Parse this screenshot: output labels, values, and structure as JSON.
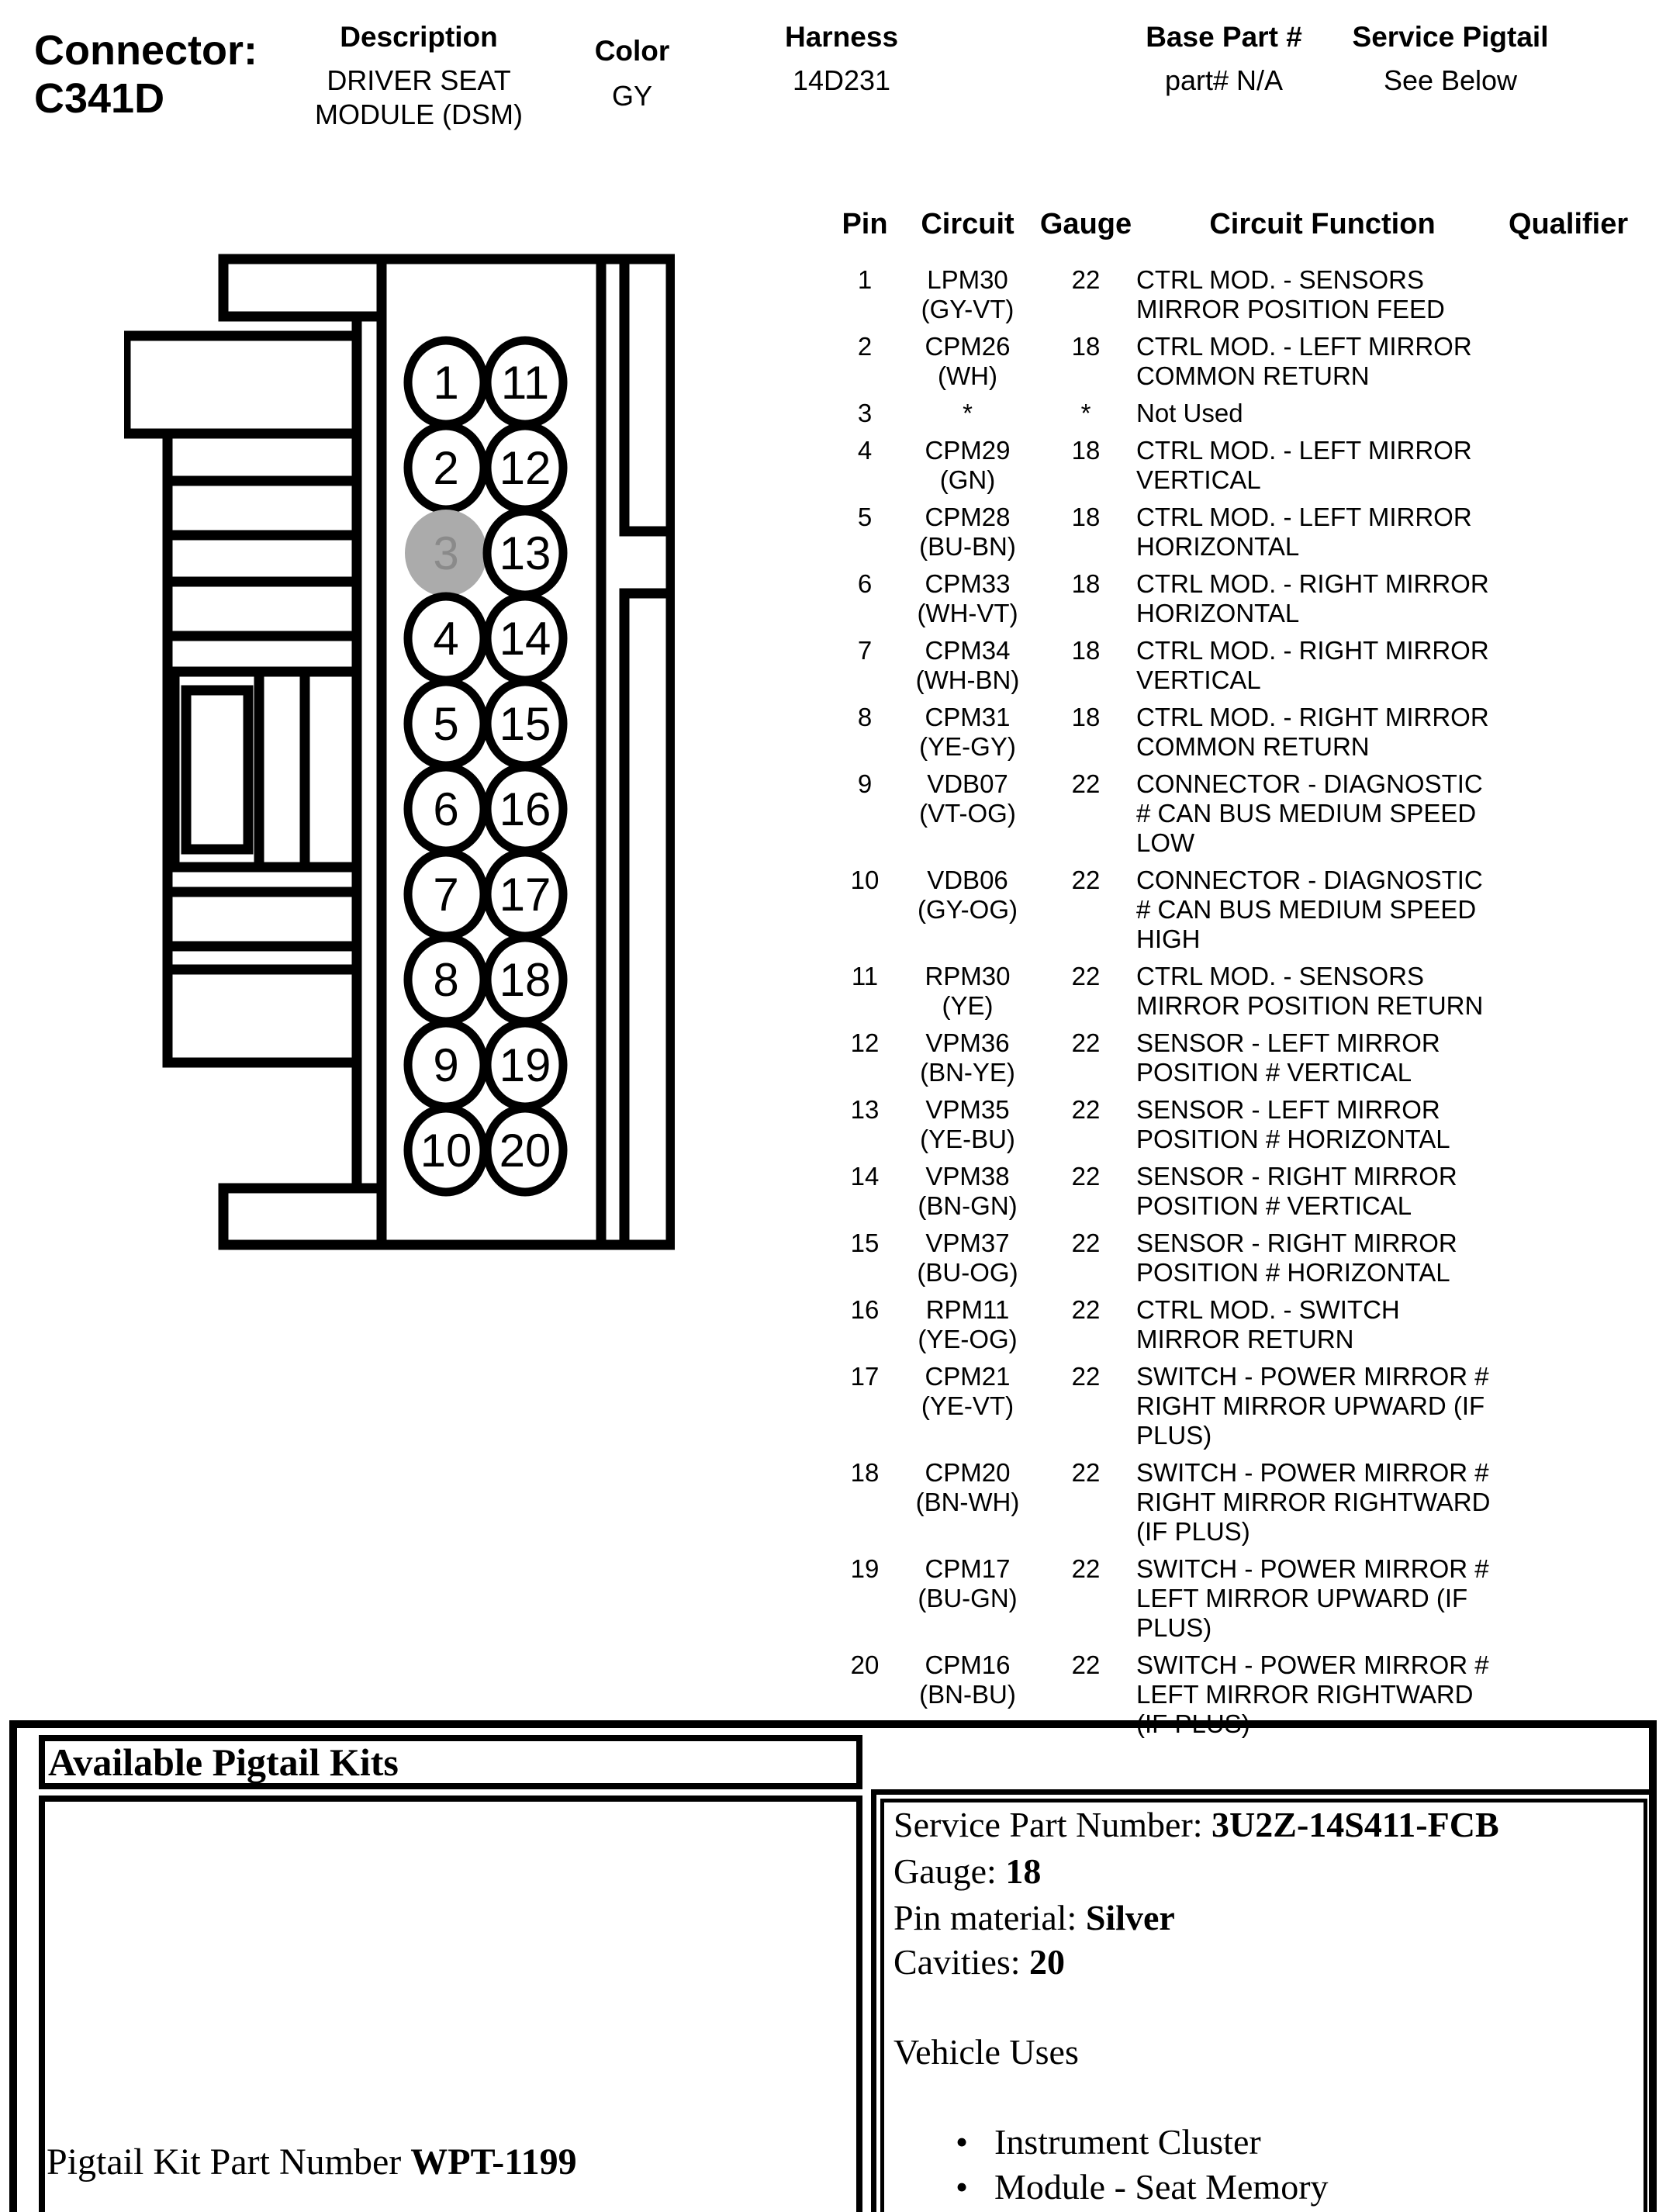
{
  "header": {
    "connector_label": "Connector:",
    "connector_id": "C341D",
    "fields": [
      {
        "label": "Description",
        "value_line1": "DRIVER SEAT",
        "value_line2": "MODULE (DSM)"
      },
      {
        "label": "Color",
        "value": "GY"
      },
      {
        "label": "Harness",
        "value": "14D231"
      },
      {
        "label": "Base Part #",
        "value": "part# N/A"
      },
      {
        "label": "Service Pigtail",
        "value": "See Below"
      }
    ]
  },
  "pin_table": {
    "columns": [
      "Pin",
      "Circuit",
      "Gauge",
      "Circuit Function",
      "Qualifier"
    ],
    "rows": [
      {
        "pin": "1",
        "circuit": "LPM30",
        "color": "(GY-VT)",
        "gauge": "22",
        "function": "CTRL MOD. - SENSORS MIRROR POSITION FEED",
        "qualifier": ""
      },
      {
        "pin": "2",
        "circuit": "CPM26",
        "color": "(WH)",
        "gauge": "18",
        "function": "CTRL MOD. - LEFT MIRROR COMMON RETURN",
        "qualifier": ""
      },
      {
        "pin": "3",
        "circuit": "*",
        "color": "",
        "gauge": "*",
        "function": "Not Used",
        "qualifier": ""
      },
      {
        "pin": "4",
        "circuit": "CPM29",
        "color": "(GN)",
        "gauge": "18",
        "function": "CTRL MOD. - LEFT MIRROR VERTICAL",
        "qualifier": ""
      },
      {
        "pin": "5",
        "circuit": "CPM28",
        "color": "(BU-BN)",
        "gauge": "18",
        "function": "CTRL MOD. - LEFT MIRROR HORIZONTAL",
        "qualifier": ""
      },
      {
        "pin": "6",
        "circuit": "CPM33",
        "color": "(WH-VT)",
        "gauge": "18",
        "function": "CTRL MOD. - RIGHT MIRROR HORIZONTAL",
        "qualifier": ""
      },
      {
        "pin": "7",
        "circuit": "CPM34",
        "color": "(WH-BN)",
        "gauge": "18",
        "function": "CTRL MOD. - RIGHT MIRROR VERTICAL",
        "qualifier": ""
      },
      {
        "pin": "8",
        "circuit": "CPM31",
        "color": "(YE-GY)",
        "gauge": "18",
        "function": "CTRL MOD. - RIGHT MIRROR COMMON RETURN",
        "qualifier": ""
      },
      {
        "pin": "9",
        "circuit": "VDB07",
        "color": "(VT-OG)",
        "gauge": "22",
        "function": "CONNECTOR - DIAGNOSTIC # CAN BUS MEDIUM SPEED LOW",
        "qualifier": ""
      },
      {
        "pin": "10",
        "circuit": "VDB06",
        "color": "(GY-OG)",
        "gauge": "22",
        "function": "CONNECTOR - DIAGNOSTIC # CAN BUS MEDIUM SPEED HIGH",
        "qualifier": ""
      },
      {
        "pin": "11",
        "circuit": "RPM30",
        "color": "(YE)",
        "gauge": "22",
        "function": "CTRL MOD. - SENSORS MIRROR POSITION RETURN",
        "qualifier": ""
      },
      {
        "pin": "12",
        "circuit": "VPM36",
        "color": "(BN-YE)",
        "gauge": "22",
        "function": "SENSOR - LEFT MIRROR POSITION # VERTICAL",
        "qualifier": ""
      },
      {
        "pin": "13",
        "circuit": "VPM35",
        "color": "(YE-BU)",
        "gauge": "22",
        "function": "SENSOR - LEFT MIRROR POSITION # HORIZONTAL",
        "qualifier": ""
      },
      {
        "pin": "14",
        "circuit": "VPM38",
        "color": "(BN-GN)",
        "gauge": "22",
        "function": "SENSOR - RIGHT MIRROR POSITION # VERTICAL",
        "qualifier": ""
      },
      {
        "pin": "15",
        "circuit": "VPM37",
        "color": "(BU-OG)",
        "gauge": "22",
        "function": "SENSOR - RIGHT MIRROR POSITION # HORIZONTAL",
        "qualifier": ""
      },
      {
        "pin": "16",
        "circuit": "RPM11",
        "color": "(YE-OG)",
        "gauge": "22",
        "function": "CTRL MOD. - SWITCH MIRROR RETURN",
        "qualifier": ""
      },
      {
        "pin": "17",
        "circuit": "CPM21",
        "color": "(YE-VT)",
        "gauge": "22",
        "function": "SWITCH - POWER MIRROR # RIGHT MIRROR UPWARD (IF PLUS)",
        "qualifier": ""
      },
      {
        "pin": "18",
        "circuit": "CPM20",
        "color": "(BN-WH)",
        "gauge": "22",
        "function": "SWITCH - POWER MIRROR # RIGHT MIRROR RIGHTWARD (IF PLUS)",
        "qualifier": ""
      },
      {
        "pin": "19",
        "circuit": "CPM17",
        "color": "(BU-GN)",
        "gauge": "22",
        "function": "SWITCH - POWER MIRROR # LEFT MIRROR UPWARD (IF PLUS)",
        "qualifier": ""
      },
      {
        "pin": "20",
        "circuit": "CPM16",
        "color": "(BN-BU)",
        "gauge": "22",
        "function": "SWITCH - POWER MIRROR # LEFT MIRROR RIGHTWARD (IF PLUS)",
        "qualifier": ""
      }
    ]
  },
  "connector_diagram": {
    "left_pins": [
      "1",
      "2",
      "3",
      "4",
      "5",
      "6",
      "7",
      "8",
      "9",
      "10"
    ],
    "right_pins": [
      "11",
      "12",
      "13",
      "14",
      "15",
      "16",
      "17",
      "18",
      "19",
      "20"
    ],
    "shaded_pin": "3",
    "shade_fill": "#ababab",
    "shade_text": "#8a8a8a",
    "outline_color": "#000000"
  },
  "pigtail": {
    "title": "Available Pigtail Kits",
    "kit_label": "Pigtail Kit Part Number",
    "kit_number": "WPT-1199",
    "service_lines": [
      {
        "label": "Service Part Number: ",
        "value": "3U2Z-14S411-FCB"
      },
      {
        "label": "Gauge: ",
        "value": "18"
      },
      {
        "label": "Pin material: ",
        "value": "Silver"
      },
      {
        "label": "Cavities: ",
        "value": "20"
      }
    ],
    "vehicle_uses_title": "Vehicle Uses",
    "vehicle_uses": [
      "Instrument Cluster",
      "Module - Seat Memory"
    ],
    "bullet": "•"
  }
}
